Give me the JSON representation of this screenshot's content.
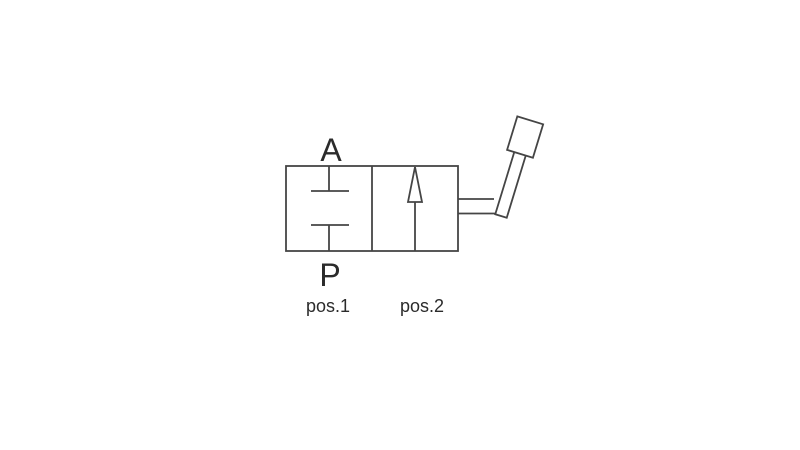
{
  "labels": {
    "port_top": "A",
    "port_bottom": "P",
    "pos1": "pos.1",
    "pos2": "pos.2"
  },
  "symbols": {
    "position_1": "blocked-ports-symbol",
    "position_2": "flow-arrow-symbol",
    "actuator": "hand-lever-symbol"
  },
  "colors": {
    "line": "#454545",
    "text": "#2b2b2b",
    "background": "#ffffff"
  }
}
